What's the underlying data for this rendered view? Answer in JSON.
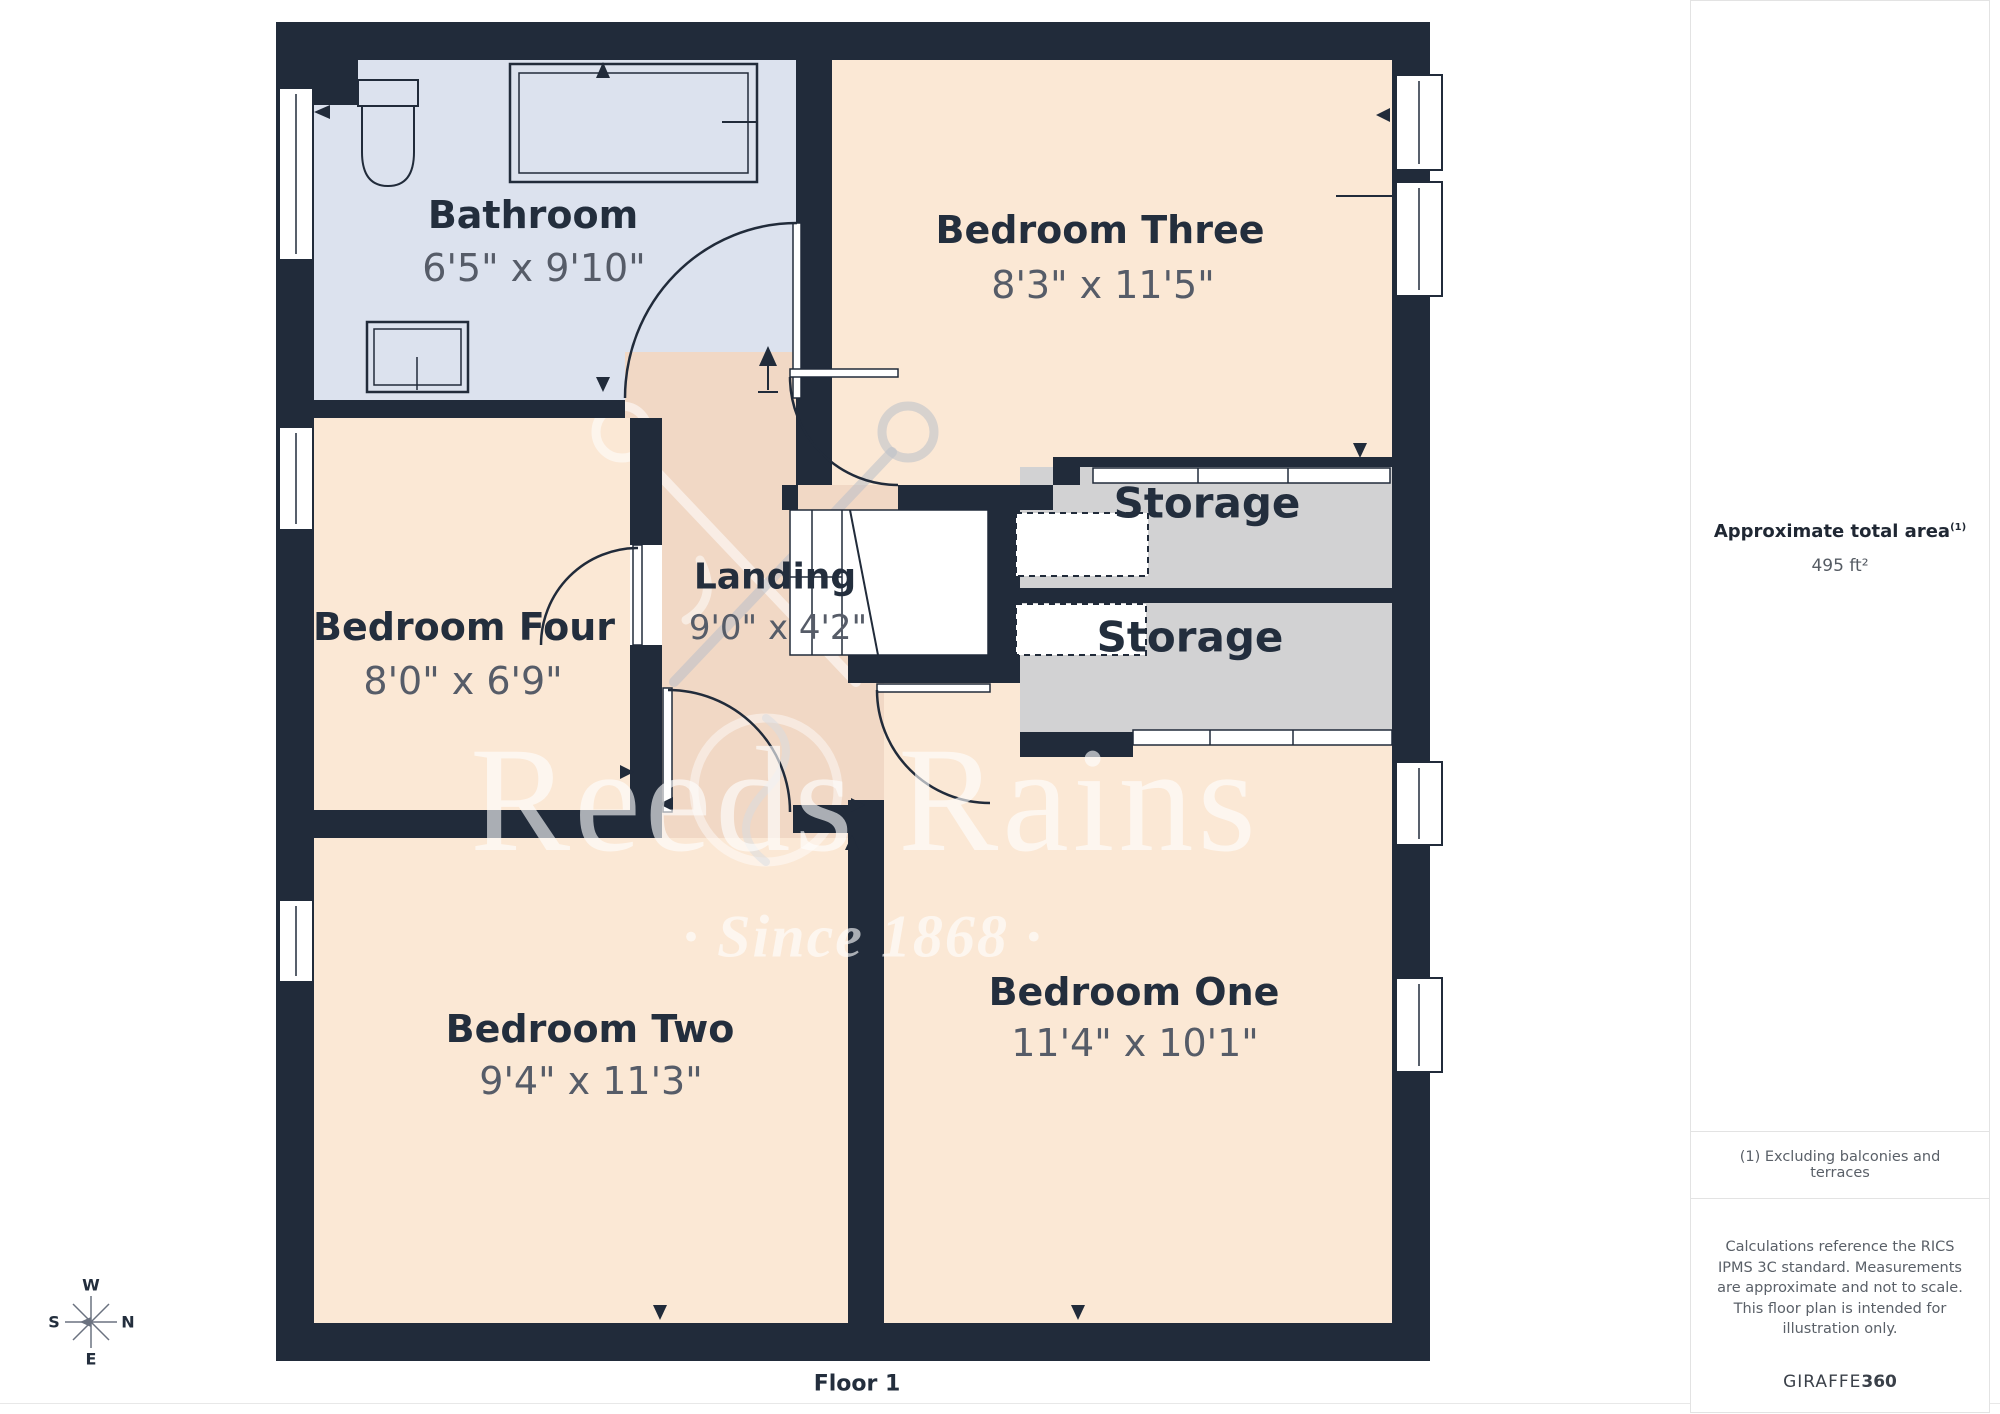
{
  "floor_label": "Floor 1",
  "watermark": {
    "brand": "Reeds Rains",
    "tagline": "· Since 1868 ·"
  },
  "rooms": [
    {
      "name": "Bathroom",
      "dims": "6'5\" x 9'10\""
    },
    {
      "name": "Bedroom Three",
      "dims": "8'3\" x 11'5\""
    },
    {
      "name": "Bedroom Four",
      "dims": "8'0\" x 6'9\""
    },
    {
      "name": "Landing",
      "dims": "9'0\" x 4'2\""
    },
    {
      "name": "Storage",
      "dims": ""
    },
    {
      "name": "Storage",
      "dims": ""
    },
    {
      "name": "Bedroom Two",
      "dims": "9'4\" x 11'3\""
    },
    {
      "name": "Bedroom One",
      "dims": "11'4\" x 10'1\""
    }
  ],
  "compass": {
    "n": "N",
    "s": "S",
    "e": "E",
    "w": "W"
  },
  "sidebar": {
    "area_title": "Approximate total area",
    "area_superscript": "(1)",
    "area_value": "495 ft²",
    "footnote": "(1) Excluding balconies and terraces",
    "disclaimer": "Calculations reference the RICS IPMS 3C standard. Measurements are approximate and not to scale. This floor plan is intended for illustration only.",
    "brand_regular": "GIRAFFE",
    "brand_bold": "360"
  },
  "colors": {
    "wall": "#212b3a",
    "bedroom": "#fbe8d5",
    "landing": "#f1d8c5",
    "bathroom": "#dce2ee",
    "storage": "#d2d2d3",
    "title_text": "#232e3d",
    "dim_text": "#565c68",
    "border": "#e3e3e3"
  }
}
